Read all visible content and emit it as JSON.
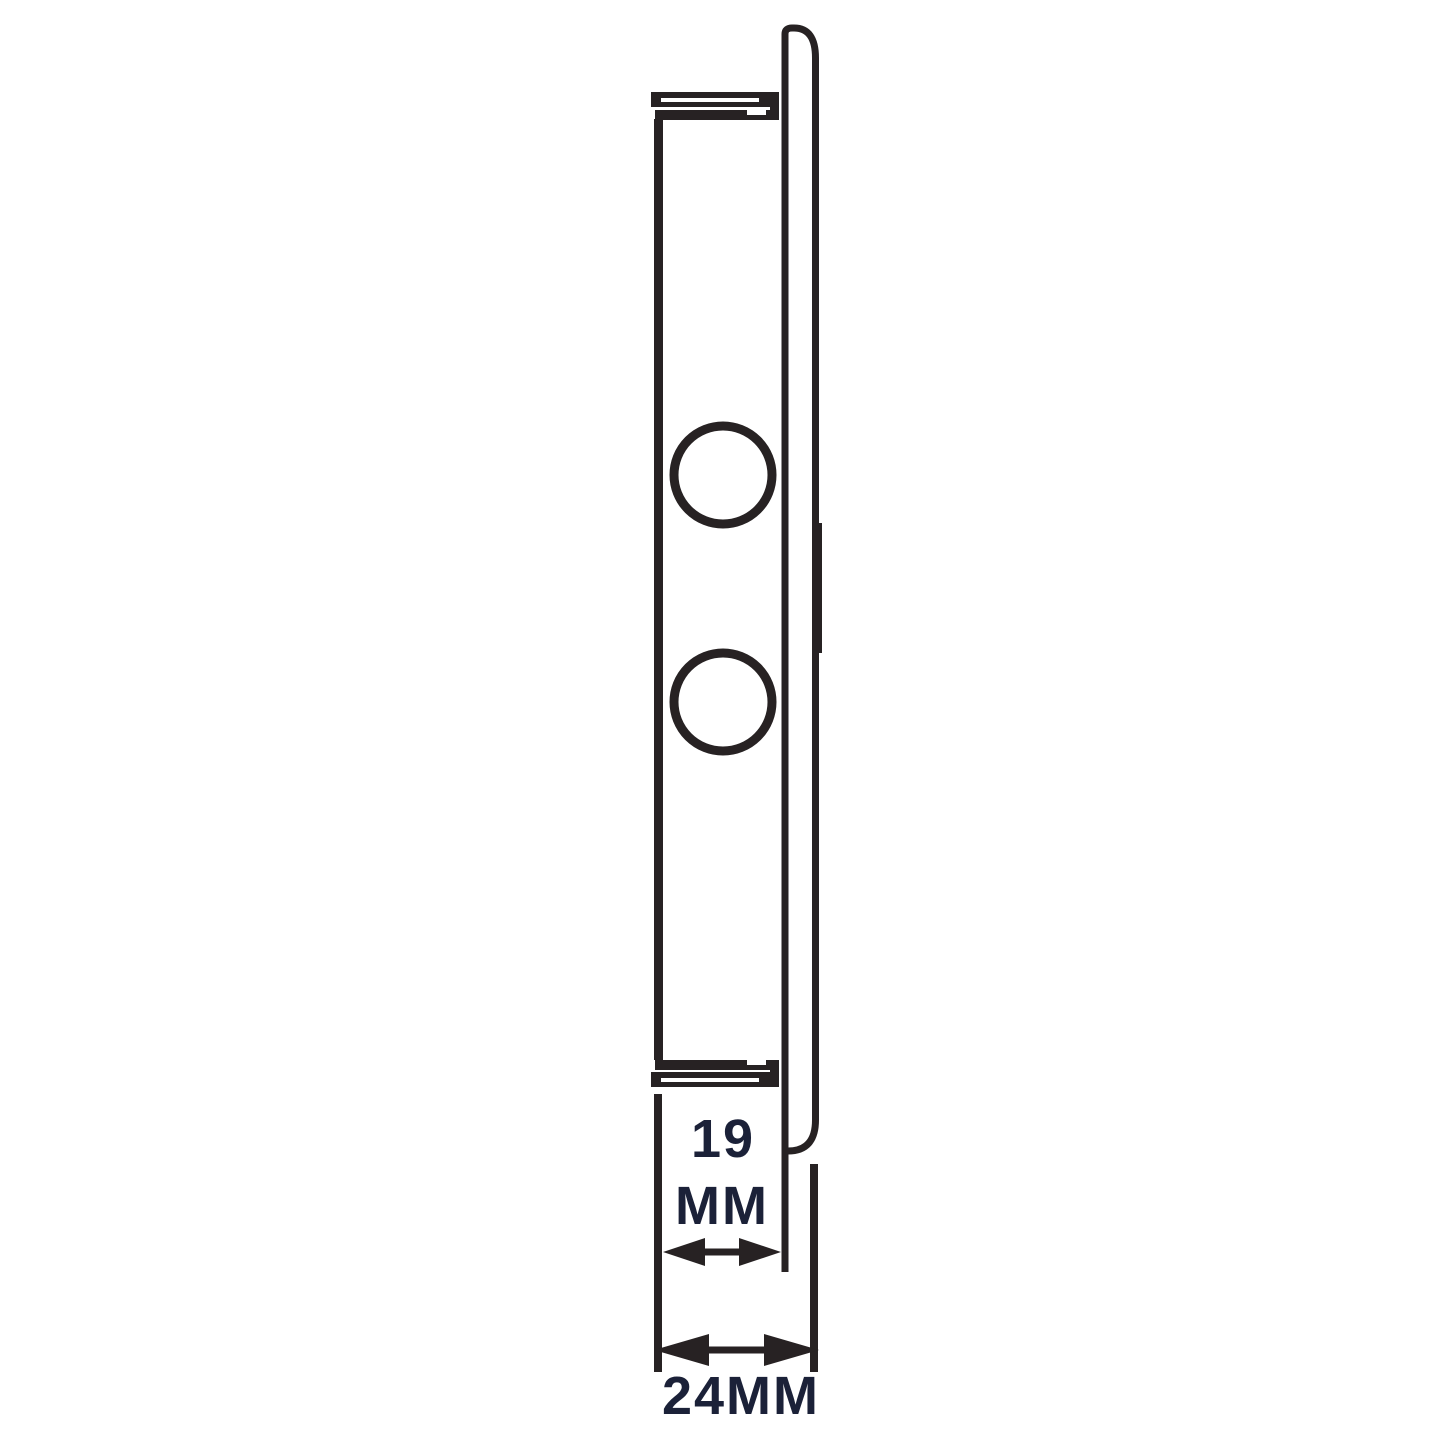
{
  "drawing": {
    "type": "technical-side-profile",
    "background_color": "#ffffff",
    "stroke_color": "#272223",
    "label_color": "#1b2138",
    "dimension_neck_depth": {
      "value": "19",
      "unit": "MM"
    },
    "dimension_overall_depth": {
      "label": "24MM"
    }
  }
}
